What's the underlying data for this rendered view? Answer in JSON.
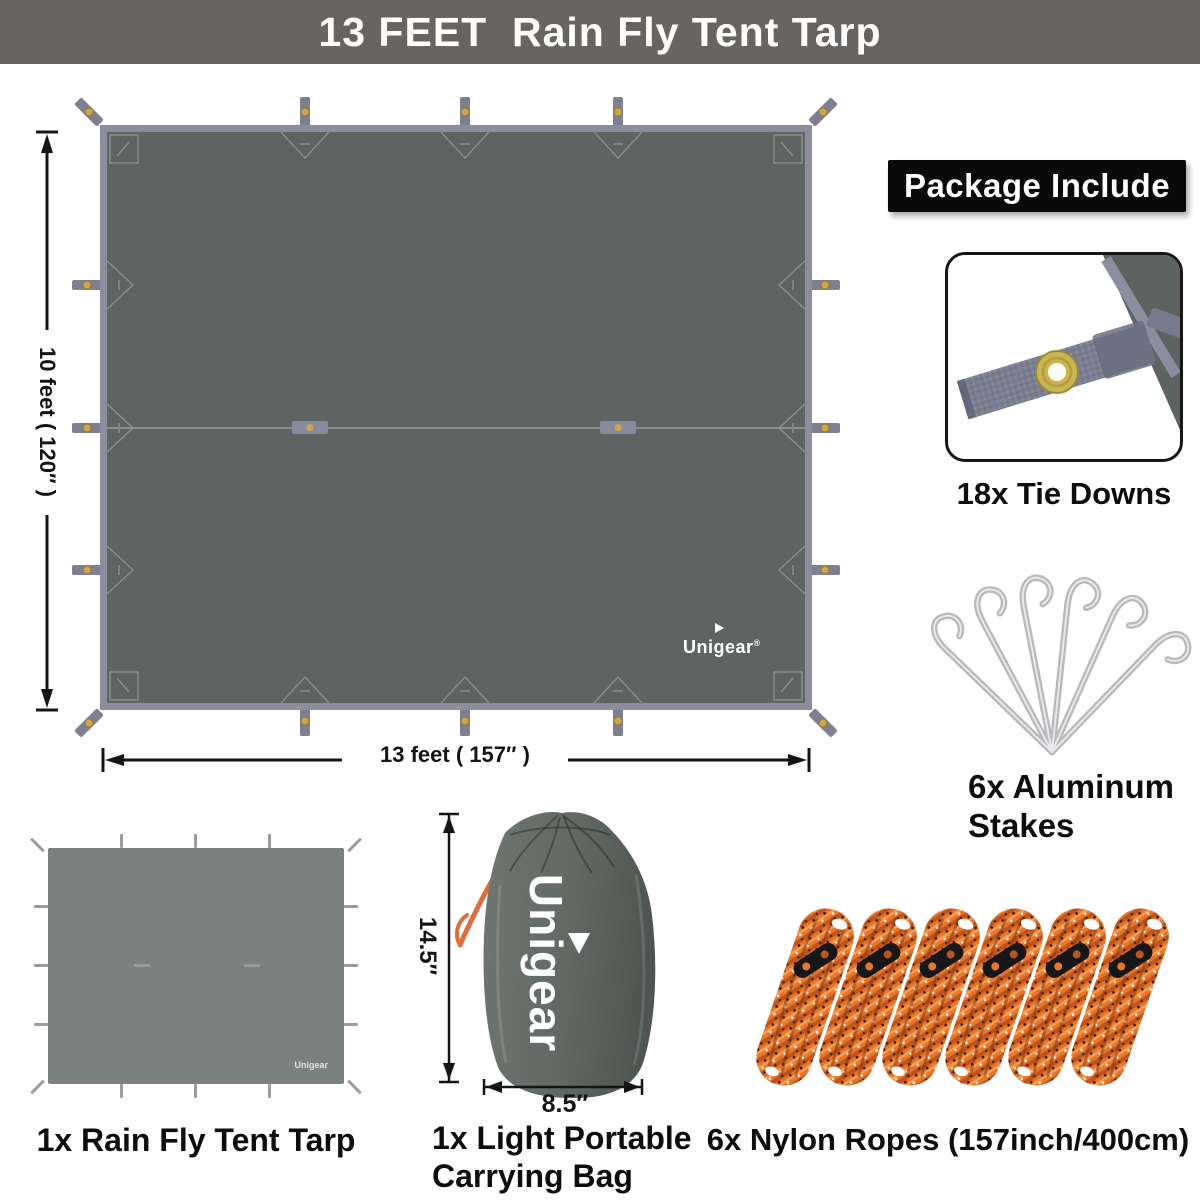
{
  "banner": {
    "title": "13 FEET  Rain Fly Tent Tarp"
  },
  "tarp_diagram": {
    "brand": "Unigear",
    "brand_reg": "®",
    "height_label": "10 feet ( 120″ )",
    "width_label": "13 feet ( 157″ )"
  },
  "package": {
    "heading": "Package Include",
    "tie_downs_label": "18x Tie Downs",
    "stakes_label": "6x Aluminum Stakes",
    "tarp_label": "1x Rain Fly Tent Tarp",
    "bag_label": "1x Light Portable Carrying Bag",
    "ropes_label": "6x Nylon Ropes (157inch/400cm)"
  },
  "bag": {
    "brand": "Unigear",
    "height_label": "14.5″",
    "width_label": "8.5″"
  },
  "small_tarp": {
    "brand": "Unigear"
  },
  "colors": {
    "banner_bg": "#676461",
    "tarp_fill": "#5e6461",
    "tarp_border": "#8d8d9e",
    "strap": "#7f7f92",
    "grommet": "#d2a44e",
    "heading_bg": "#0a0a0a",
    "rope_orange": "#e8762a",
    "cord_orange": "#df6f3b",
    "stake_silver": "#b9b9bc"
  }
}
